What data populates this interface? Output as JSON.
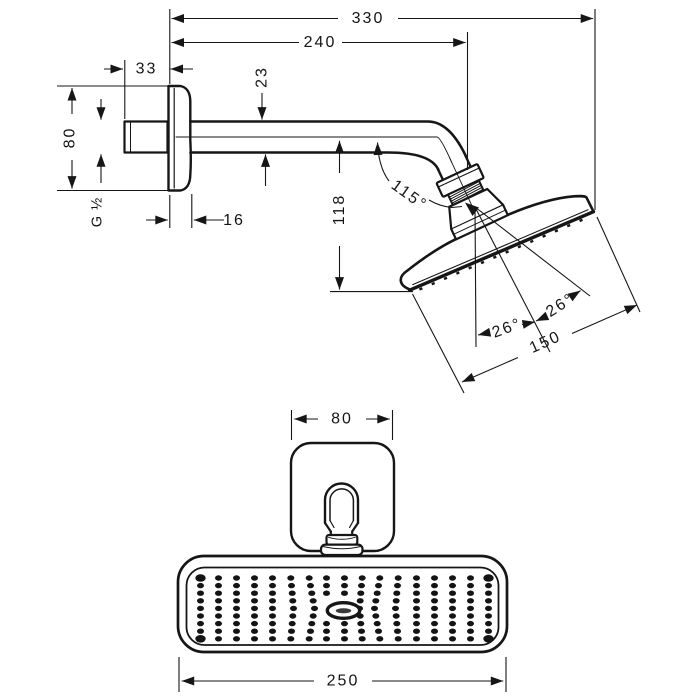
{
  "dims": {
    "overall_length": "330",
    "arm_length": "240",
    "wall_stub_length": "33",
    "arm_diameter": "23",
    "escutcheon_height": "80",
    "connection_thread": "G ½",
    "escutcheon_depth": "16",
    "drop_height": "118",
    "head_angle": "115°",
    "spray_angle_inner": "26°",
    "spray_angle_outer": "26°",
    "head_face_length": "150",
    "escutcheon_width": "80",
    "head_width": "250"
  },
  "front_view": {
    "nozzle_grid": {
      "cols": 17,
      "rows": 9,
      "x0": 200.5,
      "dx": 18,
      "y0": 578,
      "dy": 7.6,
      "rx": 3.5,
      "ry": 2.7,
      "big_rx": 5.2,
      "big_ry": 3.8,
      "skip": [
        [
          7,
          3
        ],
        [
          7,
          4
        ],
        [
          7,
          5
        ],
        [
          8,
          3
        ],
        [
          8,
          4
        ],
        [
          8,
          5
        ]
      ],
      "big": [
        [
          0,
          0
        ],
        [
          0,
          8
        ],
        [
          16,
          0
        ],
        [
          16,
          8
        ]
      ],
      "col_xshift": {
        "5": 3,
        "6": 6,
        "9": -3,
        "10": -6,
        "11": -3
      }
    }
  }
}
